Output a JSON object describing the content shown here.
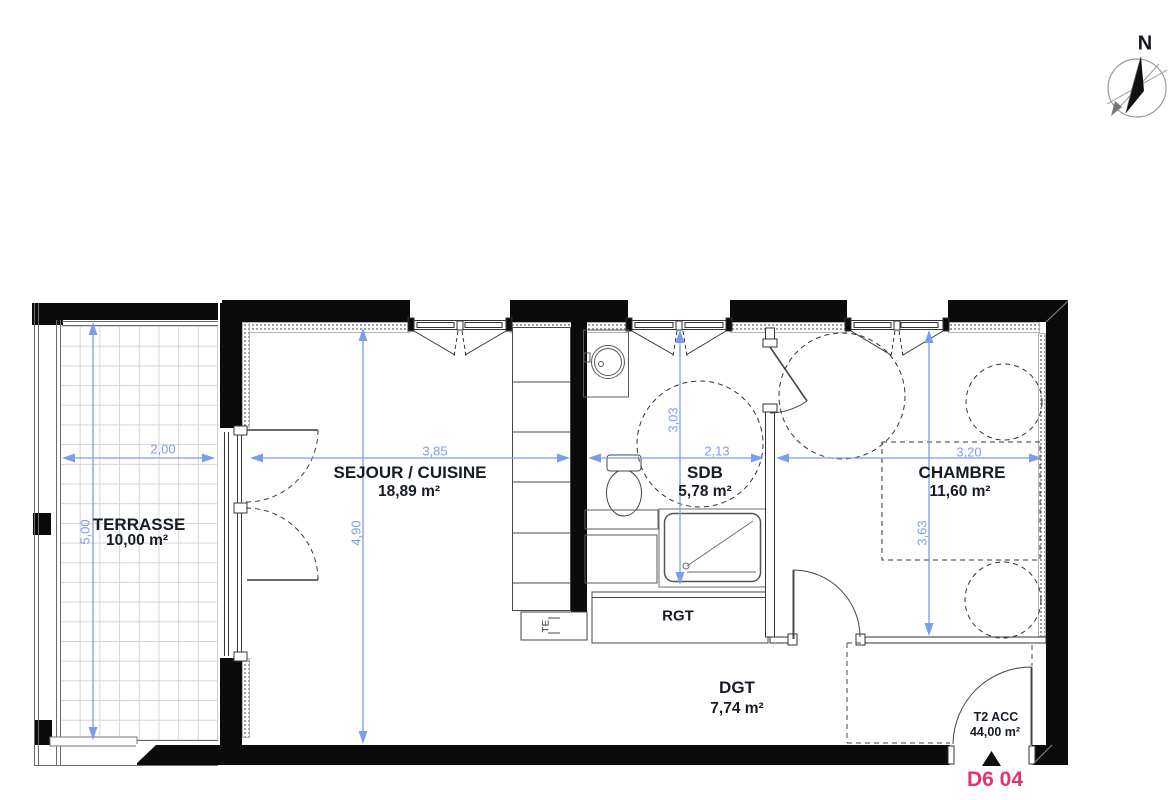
{
  "compass": {
    "label": "N"
  },
  "rooms": [
    {
      "name": "TERRASSE",
      "area": "10,00 m²"
    },
    {
      "name": "SEJOUR / CUISINE",
      "area": "18,89 m²"
    },
    {
      "name": "SDB",
      "area": "5,78 m²"
    },
    {
      "name": "CHAMBRE",
      "area": "11,60 m²"
    },
    {
      "name": "RGT"
    },
    {
      "name": "DGT",
      "area": "7,74 m²"
    }
  ],
  "unit": {
    "type": "T2 ACC",
    "area": "44,00 m²",
    "code": "D6 04"
  },
  "equipment": {
    "electrical_panel": "TE"
  },
  "dimensions": {
    "terrasse_width": "2,00",
    "terrasse_height": "5,00",
    "sejour_width": "3,85",
    "sejour_height": "4,90",
    "sdb_width": "2,13",
    "sdb_height": "3,03",
    "chambre_width": "3,20",
    "chambre_height": "3,63"
  },
  "colors": {
    "dimension_blue": "#7d9cf0",
    "plan_code_pink": "#e6316e",
    "wall_black": "#0b0b0b",
    "label_dark": "#161c26"
  }
}
